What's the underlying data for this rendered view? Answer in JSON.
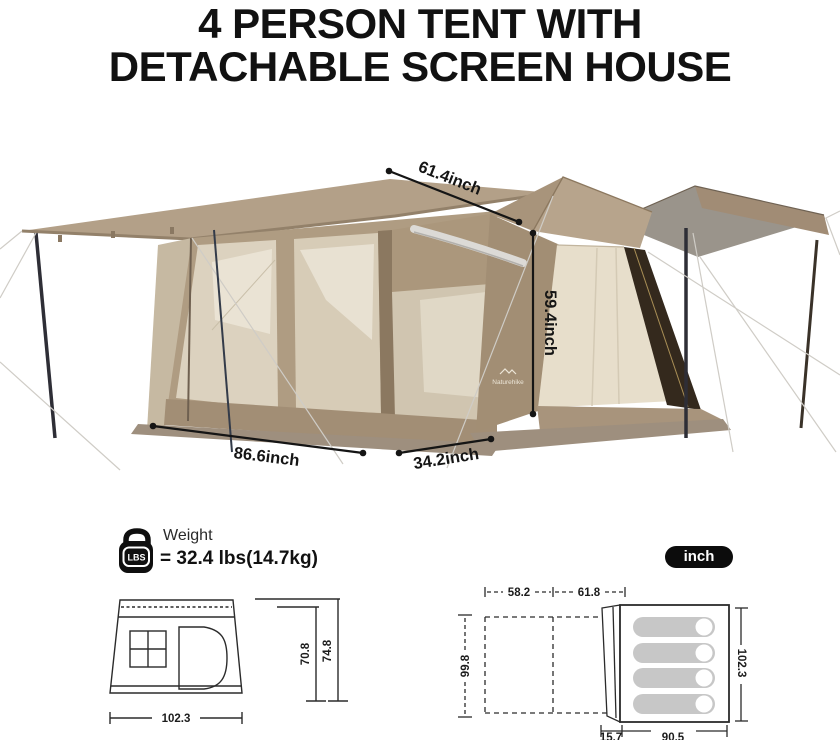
{
  "title": {
    "line1": "4 PERSON TENT WITH",
    "line2": "DETACHABLE SCREEN HOUSE"
  },
  "hero": {
    "brand": "Naturehike",
    "dims": {
      "ridge": "61.4inch",
      "height": "59.4inch",
      "screen_width": "86.6inch",
      "porch_width": "34.2inch"
    }
  },
  "weight": {
    "badge": "LBS",
    "label": "Weight",
    "value": "= 32.4 lbs(14.7kg)"
  },
  "unit_badge": {
    "label": "inch"
  },
  "side_view": {
    "width": "102.3",
    "wall_height": "70.8",
    "peak_height": "74.8"
  },
  "floor_plan": {
    "screen_section_a": "58.2",
    "screen_section_b": "61.8",
    "screen_depth": "99.8",
    "tent_depth": "102.3",
    "porch_depth": "15.7",
    "tent_width": "90.5",
    "sleeping_pads": 4
  },
  "colors": {
    "text": "#111111",
    "tent_khaki": "#b3a088",
    "mesh": "#dcd2bf",
    "awning_gray": "#9a948b",
    "badge_bg": "#0c0c0c",
    "drawing_line": "#2b2b2b",
    "pad_gray": "#c7c7c7"
  }
}
